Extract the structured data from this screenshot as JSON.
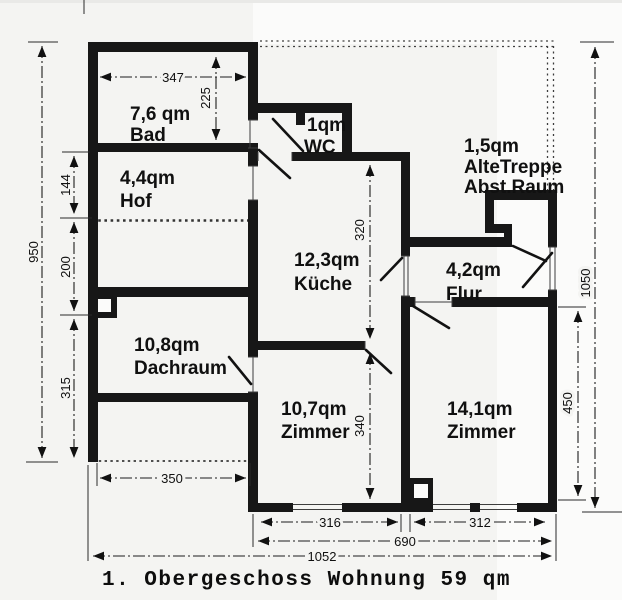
{
  "title": "1. Obergeschoss Wohnung 59 qm",
  "plan": {
    "rooms": [
      {
        "area": "7,6 qm",
        "name": "Bad"
      },
      {
        "area": "4,4qm",
        "name": "Hof"
      },
      {
        "area": "1qm",
        "name": "WC"
      },
      {
        "area": "1,5qm",
        "name": "AlteTreppe",
        "name2": "Abst.Raum"
      },
      {
        "area": "12,3qm",
        "name": "Küche"
      },
      {
        "area": "4,2qm",
        "name": "Flur"
      },
      {
        "area": "10,8qm",
        "name": "Dachraum"
      },
      {
        "area": "10,7qm",
        "name": "Zimmer"
      },
      {
        "area": "14,1qm",
        "name": "Zimmer"
      }
    ],
    "dimensions": {
      "bad_width": "347",
      "bad_height": "225",
      "left_total_height": "950",
      "hof_height": "144",
      "mid_height": "200",
      "dachraum_height": "315",
      "kueche_height": "320",
      "zimmer1_height": "340",
      "right_total_height": "1050",
      "zimmer2_height": "450",
      "dachraum_width": "350",
      "zimmer1_width": "316",
      "zimmer2_width": "312",
      "right_width": "690",
      "total_width": "1052"
    }
  }
}
